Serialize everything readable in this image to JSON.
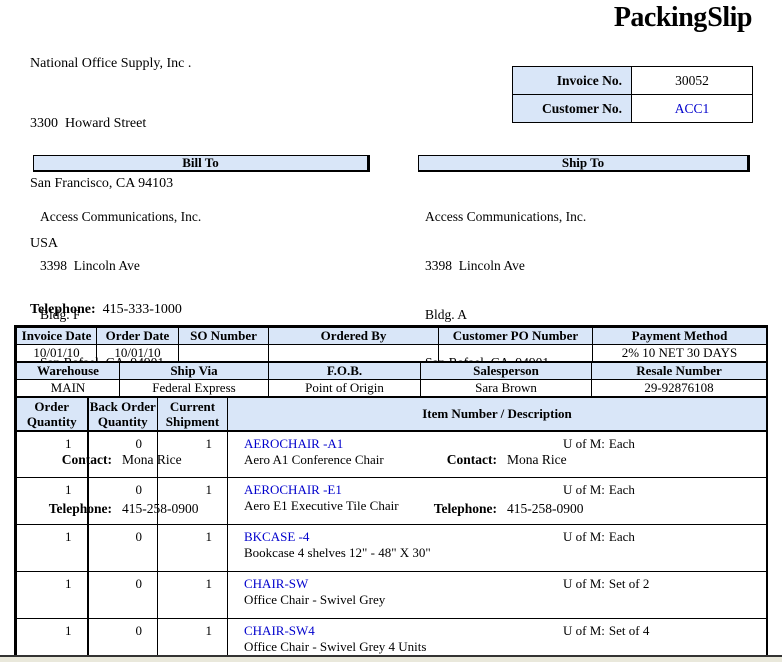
{
  "page": {
    "title": "Packing Slip"
  },
  "company": {
    "name": "National Office Supply, Inc .",
    "address_lines": [
      "3300  Howard Street",
      "San Francisco, CA 94103",
      "USA"
    ],
    "telephone_label": "Telephone:",
    "telephone": "415-333-1000"
  },
  "invoice_box": {
    "invoice_label": "Invoice No.",
    "invoice_value": "30052",
    "customer_label": "Customer No.",
    "customer_value": "ACC1"
  },
  "bill_to": {
    "header": "Bill To",
    "address_lines": [
      "Access Communications, Inc.",
      "3398  Lincoln Ave",
      "Bldg. F",
      "San Rafael, CA  94901",
      "USA"
    ],
    "contact_label": "Contact:",
    "contact": "Mona Rice",
    "telephone_label": "Telephone:",
    "telephone": "415-258-0900"
  },
  "ship_to": {
    "header": "Ship To",
    "address_lines": [
      "Access Communications, Inc.",
      "3398  Lincoln Ave",
      "Bldg. A",
      "San Rafael, CA  94901",
      "USA"
    ],
    "contact_label": "Contact:",
    "contact": "Mona Rice",
    "telephone_label": "Telephone:",
    "telephone": "415-258-0900"
  },
  "order_info": {
    "row1_headers": [
      "Invoice Date",
      "Order Date",
      "SO Number",
      "Ordered By",
      "Customer PO Number",
      "Payment Method"
    ],
    "row1_values": [
      "10/01/10",
      "10/01/10",
      "",
      "",
      "",
      "2% 10 NET 30 DAYS"
    ],
    "row2_headers": [
      "Warehouse",
      "Ship Via",
      "F.O.B.",
      "Salesperson",
      "Resale Number"
    ],
    "row2_values": [
      "MAIN",
      "Federal Express",
      "Point of Origin",
      "Sara Brown",
      "29-92876108"
    ]
  },
  "items": {
    "col_headers": [
      "Order\nQuantity",
      "Back Order\nQuantity",
      "Current\nShipment",
      "Item Number / Description"
    ],
    "uom_label": "U of M:",
    "rows": [
      {
        "order_qty": "1",
        "back_order_qty": "0",
        "current_shipment": "1",
        "item_number": "AEROCHAIR -A1",
        "description": "Aero A1 Conference Chair",
        "uom": "Each"
      },
      {
        "order_qty": "1",
        "back_order_qty": "0",
        "current_shipment": "1",
        "item_number": "AEROCHAIR -E1",
        "description": "Aero E1 Executive Tile Chair",
        "uom": "Each"
      },
      {
        "order_qty": "1",
        "back_order_qty": "0",
        "current_shipment": "1",
        "item_number": "BKCASE -4",
        "description": "Bookcase 4 shelves 12\" - 48\" X 30\"",
        "uom": "Each"
      },
      {
        "order_qty": "1",
        "back_order_qty": "0",
        "current_shipment": "1",
        "item_number": "CHAIR-SW",
        "description": "Office Chair  - Swivel Grey",
        "uom": "Set of 2"
      },
      {
        "order_qty": "1",
        "back_order_qty": "0",
        "current_shipment": "1",
        "item_number": "CHAIR-SW4",
        "description": "Office Chair  - Swivel Grey  4 Units",
        "uom": "Set of 4"
      }
    ]
  },
  "colors": {
    "header_bg": "#d9e6f8",
    "link_blue": "#0000cc",
    "border": "#000000",
    "page_edge": "#e9e8db"
  }
}
